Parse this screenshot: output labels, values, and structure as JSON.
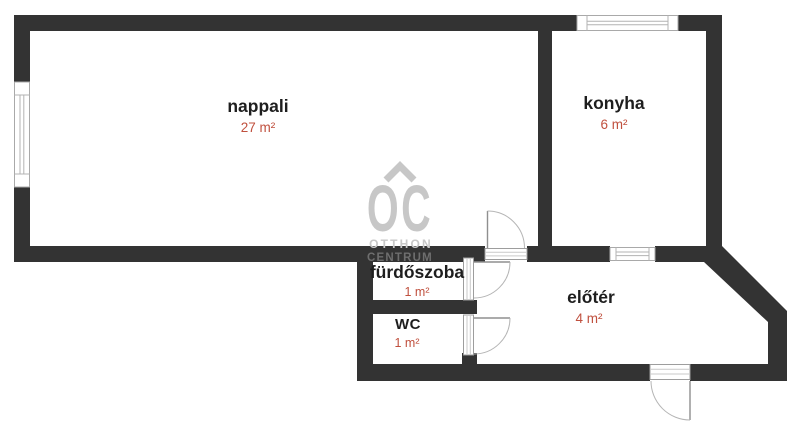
{
  "plan": {
    "type": "apartment-floor-plan",
    "rooms": [
      {
        "name": "nappali",
        "area": "27 m²"
      },
      {
        "name": "konyha",
        "area": "6 m²"
      },
      {
        "name": "fürdőszoba",
        "area": "1 m²"
      },
      {
        "name": "WC",
        "area": "1 m²"
      },
      {
        "name": "előtér",
        "area": "4 m²"
      }
    ]
  },
  "watermark": {
    "logo": "OC",
    "roof_icon": "house-roof-chevron",
    "line1": "OTTHON",
    "line2": "CENTRUM"
  },
  "colors": {
    "wall": "#333333",
    "room_label": "#1e1e1e",
    "area_label": "#c0503e",
    "watermark_light": "#c7c7c7",
    "watermark_on_wall": "#6e6e6e",
    "symbol_stroke": "#a9a9a9",
    "background": "#ffffff"
  }
}
